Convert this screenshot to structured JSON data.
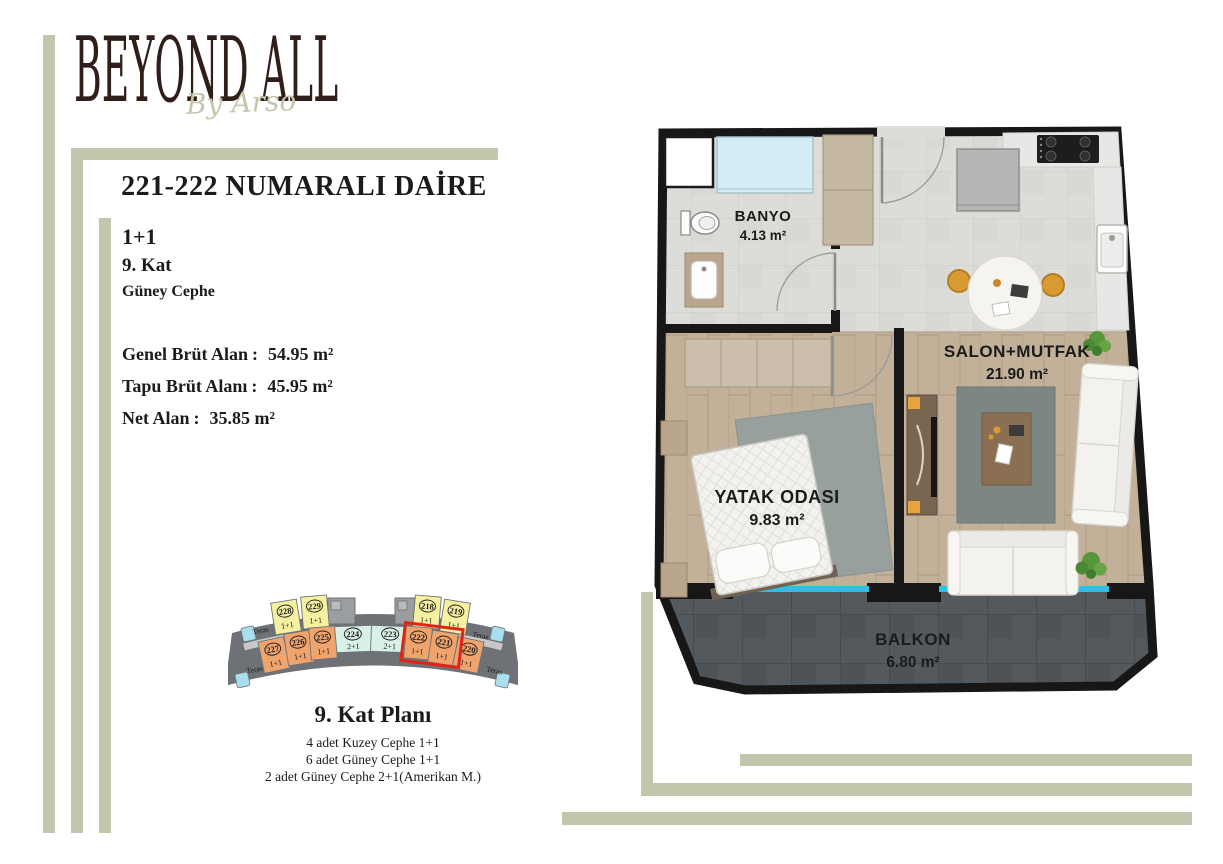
{
  "brand": {
    "name": "BEYOND ALL",
    "tagline": "By Arso"
  },
  "page": {
    "title": "221-222 NUMARALI DAİRE"
  },
  "specs": {
    "type": "1+1",
    "floor": "9. Kat",
    "facade": "Güney Cephe"
  },
  "areas": {
    "separator": ":",
    "rows": [
      {
        "label": "Genel Brüt Alan",
        "value": "54.95 m²"
      },
      {
        "label": "Tapu Brüt Alanı",
        "value": "45.95 m²"
      },
      {
        "label": "Net Alan",
        "value": "35.85 m²"
      }
    ]
  },
  "floorplan": {
    "rooms": [
      {
        "name": "BANYO",
        "area": "4.13 m²"
      },
      {
        "name": "SALON+MUTFAK",
        "area": "21.90 m²"
      },
      {
        "name": "YATAK ODASI",
        "area": "9.83 m²"
      },
      {
        "name": "BALKON",
        "area": "6.80 m²"
      }
    ]
  },
  "keyplan": {
    "title": "9. Kat Planı",
    "legend": [
      "4 adet Kuzey Cephe 1+1",
      "6 adet Güney Cephe 1+1",
      "2 adet Güney Cephe 2+1(Amerikan M.)"
    ],
    "teras_label": "Teras",
    "units": [
      {
        "number": "228",
        "type": "1+1"
      },
      {
        "number": "229",
        "type": "1+1"
      },
      {
        "number": "218",
        "type": "1+1"
      },
      {
        "number": "219",
        "type": "1+1"
      },
      {
        "number": "224",
        "type": "2+1"
      },
      {
        "number": "223",
        "type": "2+1"
      },
      {
        "number": "227",
        "type": "1+1"
      },
      {
        "number": "226",
        "type": "1+1"
      },
      {
        "number": "225",
        "type": "1+1"
      },
      {
        "number": "222",
        "type": "1+1"
      },
      {
        "number": "221",
        "type": "1+1"
      },
      {
        "number": "220",
        "type": "1+1"
      }
    ]
  },
  "colors": {
    "sage": "#c3c6ab",
    "logo_brown": "#2f1e19",
    "highlight_red": "#e02517",
    "glass_cyan": "#2ac1e4",
    "unit_yellow": "#f5f1a0",
    "unit_orange": "#f0a46d",
    "unit_mint": "#d8f0e6",
    "terrace_blue": "#a8dff0",
    "building_gray": "#6e7175"
  }
}
